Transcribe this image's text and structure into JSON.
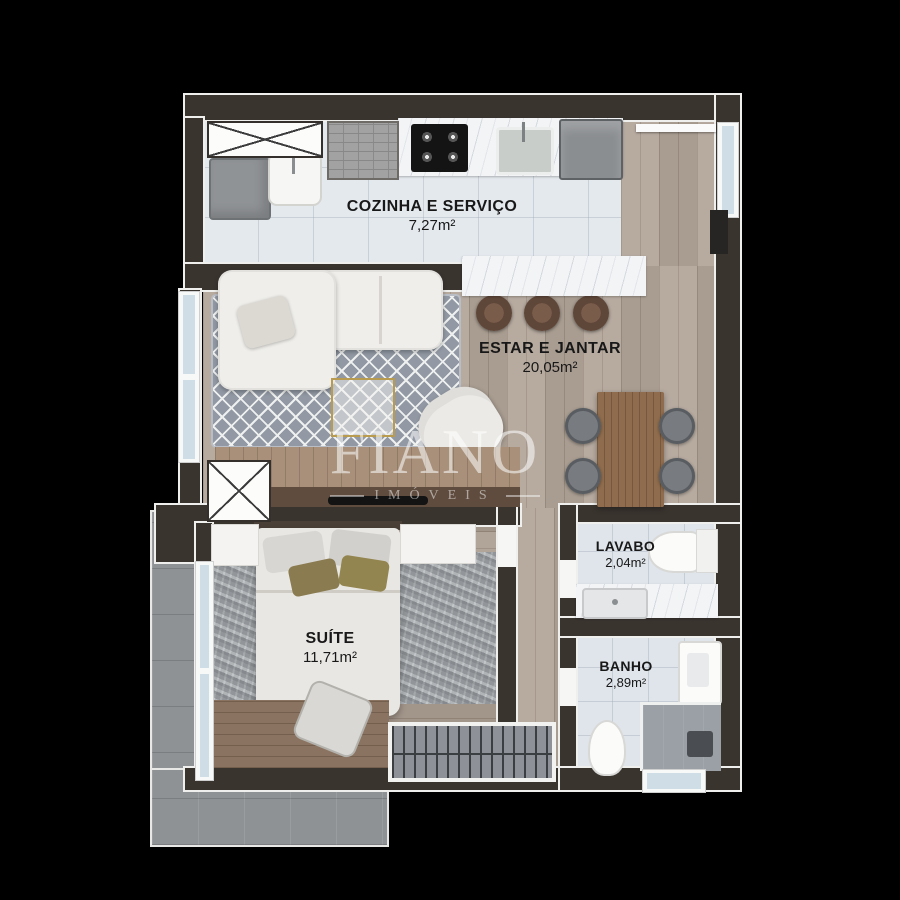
{
  "plan": {
    "rooms": [
      {
        "id": "cozinha-e-servico",
        "name": "COZINHA E SERVIÇO",
        "area": "7,27m²"
      },
      {
        "id": "estar-e-jantar",
        "name": "ESTAR E JANTAR",
        "area": "20,05m²"
      },
      {
        "id": "suite",
        "name": "SUÍTE",
        "area": "11,71m²"
      },
      {
        "id": "lavabo",
        "name": "LAVABO",
        "area": "2,04m²"
      },
      {
        "id": "banho",
        "name": "BANHO",
        "area": "2,89m²"
      }
    ],
    "watermark": {
      "brand": "FIANO",
      "tagline": "IMÓVEIS"
    },
    "colors": {
      "background": "#000000",
      "walls": "#3a342f",
      "tile_floor": "#e4e9ee",
      "wood_floor": "#b2a599",
      "terrace": "#8f9295",
      "rug": "#9299a4",
      "marble": "#f3f4f6",
      "accent_gold": "#b89b4e"
    }
  }
}
